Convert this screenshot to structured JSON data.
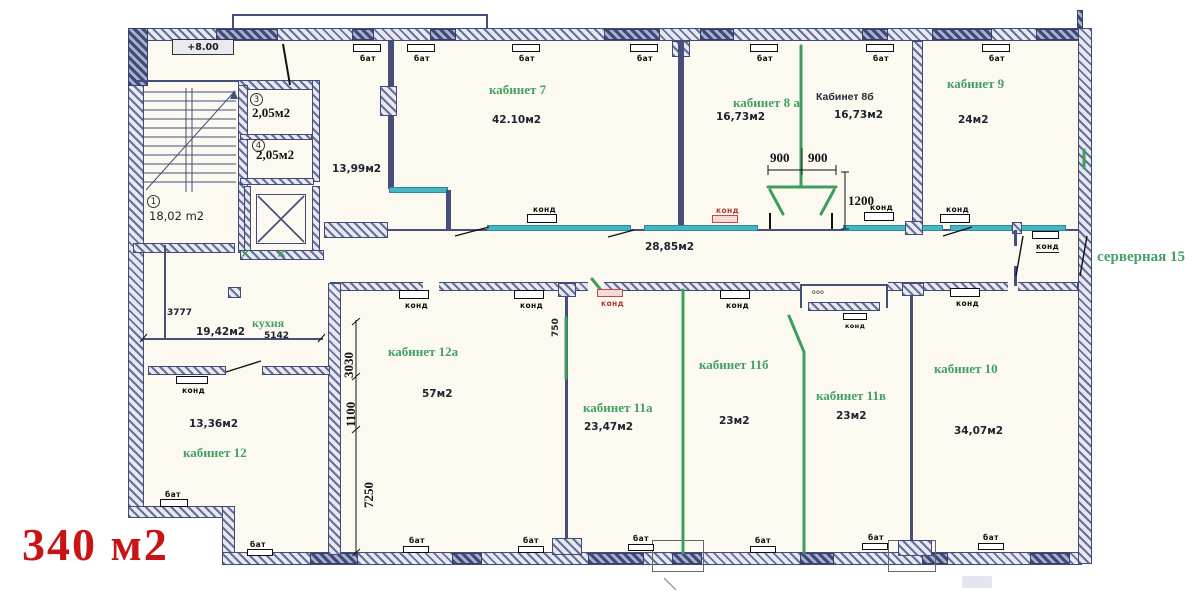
{
  "summary": {
    "total_area": "340 м2"
  },
  "plan": {
    "elevation": "+8.00",
    "corridor_area": "28,85м2"
  },
  "rooms": {
    "hall": {
      "num": "1",
      "area": "18,02 m2"
    },
    "wc1": {
      "num": "3",
      "area": "2,05м2"
    },
    "wc2": {
      "num": "4",
      "area": "2,05м2"
    },
    "room1399": {
      "area": "13,99м2"
    },
    "kab7": {
      "label": "кабинет 7",
      "area": "42.10м2"
    },
    "kab8a": {
      "label": "кабинет 8 а",
      "area": "16,73м2"
    },
    "kab8b": {
      "label": "Кабинет 8б",
      "area": "16,73м2"
    },
    "kab9": {
      "label": "кабинет 9",
      "area": "24м2"
    },
    "server": {
      "label": "серверная 15"
    },
    "kitchen": {
      "label": "кухня",
      "area": "19,42м2"
    },
    "kab12": {
      "label": "кабинет 12",
      "area": "13,36м2"
    },
    "kab12a": {
      "label": "кабинет 12а",
      "area": "57м2"
    },
    "kab11a": {
      "label": "кабинет 11а",
      "area": "23,47м2"
    },
    "kab11b": {
      "label": "кабинет 11б",
      "area": "23м2"
    },
    "kab11v": {
      "label": "кабинет 11в",
      "area": "23м2"
    },
    "kab10": {
      "label": "кабинет 10",
      "area": "34,07м2"
    }
  },
  "dims": {
    "d900l": "900",
    "d900r": "900",
    "d1200": "1200",
    "d3777": "3777",
    "d5142": "5142",
    "d3030": "3030",
    "d1100": "1100",
    "d7250": "7250",
    "d750": "750"
  },
  "equipment": {
    "radiator": "бат",
    "ac": "конд",
    "vent": "ooo"
  },
  "colors": {
    "green": "#3f9e5f",
    "cyan": "#46b6c7",
    "red": "#c81414",
    "ink": "#414b75"
  }
}
